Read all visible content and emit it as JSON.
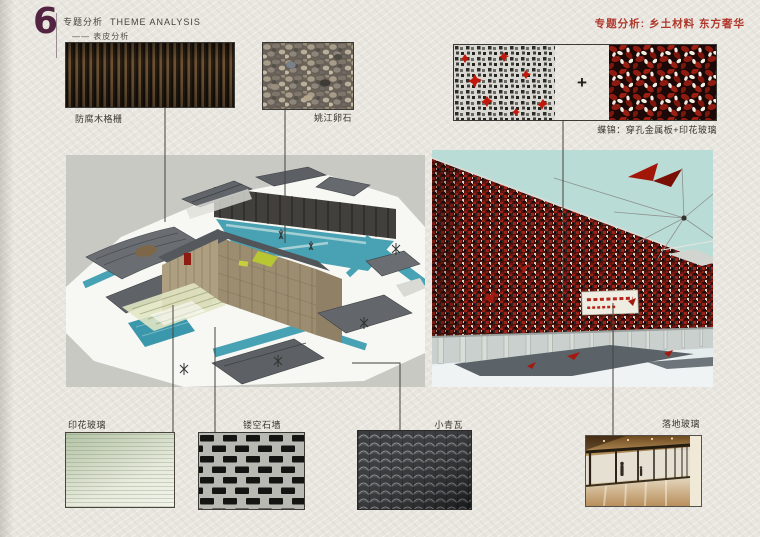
{
  "header": {
    "section_number": "6",
    "title_zh": "专题分析",
    "title_en": "THEME ANALYSIS",
    "subtitle": "—— 表皮分析",
    "right_title": "专题分析: 乡土材料 东方奢华"
  },
  "materials": {
    "wood_grille": {
      "label": "防腐木格栅"
    },
    "pebbles": {
      "label": "姚江卵石"
    },
    "metal_glass_combo": {
      "label": "蝶锦：穿孔金属板+印花玻璃",
      "plus_sign": "+"
    },
    "printed_glass": {
      "label": "印花玻璃"
    },
    "hollow_stone_wall": {
      "label": "镂空石墙"
    },
    "grey_tile": {
      "label": "小青瓦"
    },
    "floor_glass": {
      "label": "落地玻璃"
    }
  },
  "colors": {
    "paper": "#e9e6df",
    "header_plum": "#532441",
    "accent_red": "#b0372c",
    "pool_teal": "#47a2b4",
    "facade_red": "#8e1c12",
    "roof_grey": "#63676b",
    "render_sky": "#badcd7"
  }
}
